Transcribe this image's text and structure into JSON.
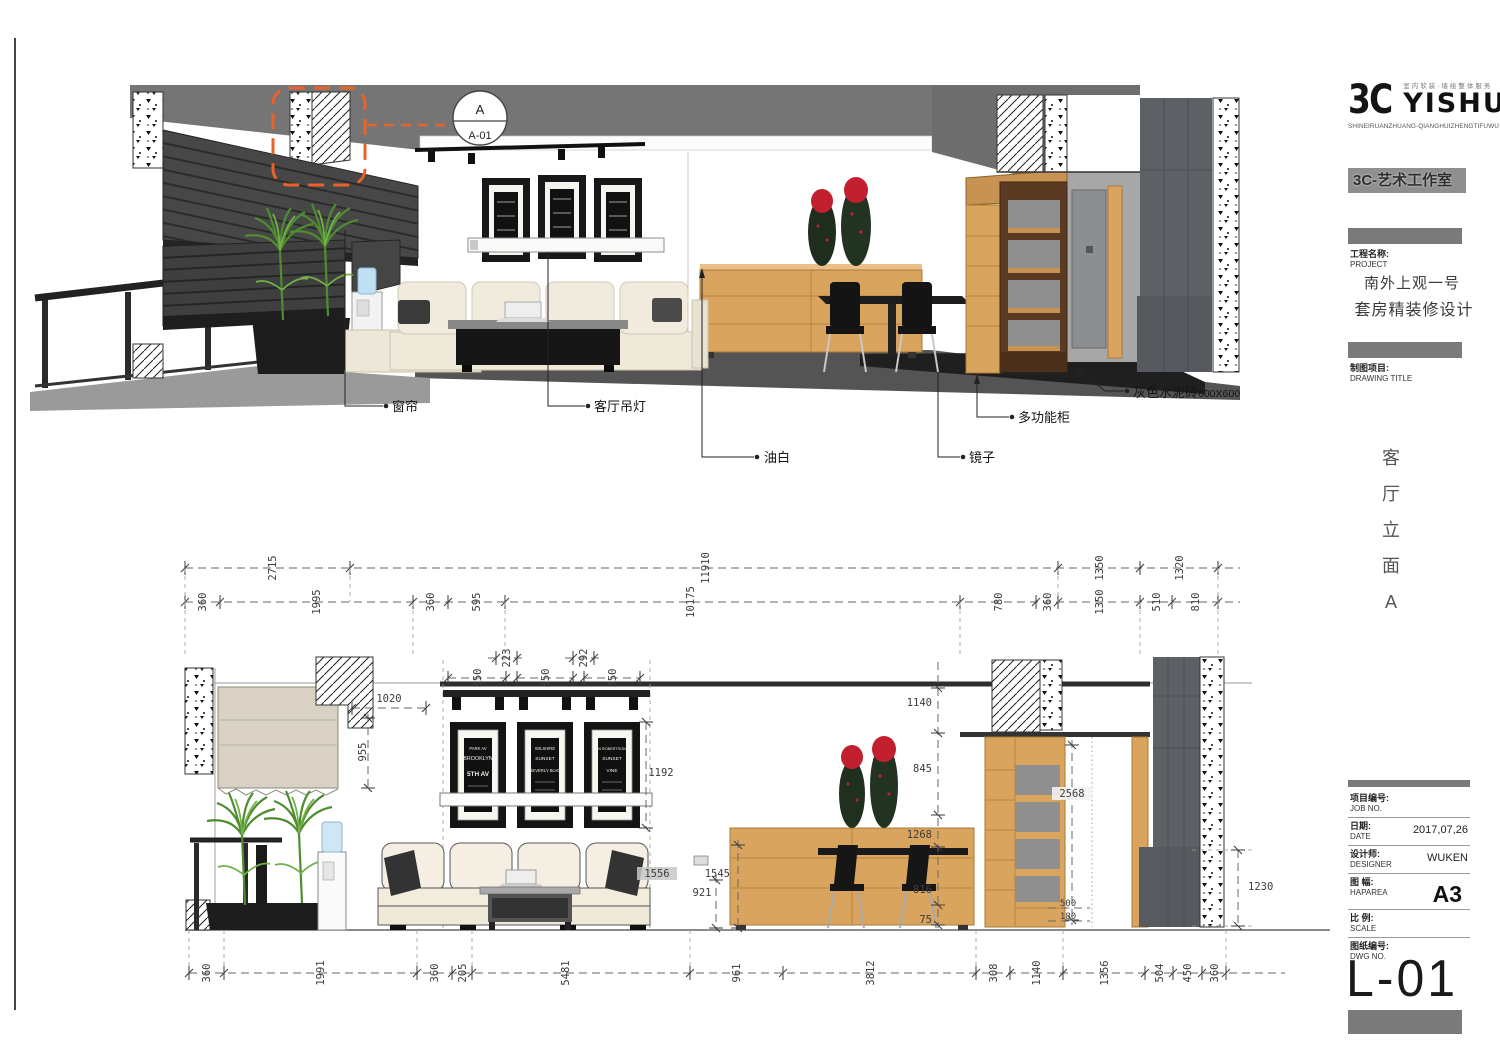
{
  "titleblock": {
    "logo_mark": "3C",
    "logo_name": "YISHU",
    "logo_tagline_cn": "室内软装·墙绘整体服务",
    "logo_tagline_py": "SHINEIRUANZHUANG-QIANGHUIZHENGTIFUWU",
    "studio": "3C-艺术工作室",
    "project_label_cn": "工程名称:",
    "project_label_en": "PROJECT",
    "project_name_line1": "南外上观一号",
    "project_name_line2": "套房精装修设计",
    "drawing_label_cn": "制图项目:",
    "drawing_label_en": "DRAWING TITLE",
    "title_chars": [
      "客",
      "厅",
      "立",
      "面",
      "A"
    ],
    "rows": [
      {
        "cn": "项目编号:",
        "en": "JOB NO.",
        "value": ""
      },
      {
        "cn": "日期:",
        "en": "DATE",
        "value": "2017,07,26"
      },
      {
        "cn": "设计师:",
        "en": "DESIGNER",
        "value": "WUKEN"
      },
      {
        "cn": "图 幅:",
        "en": "HAPAREA",
        "value": "A3"
      },
      {
        "cn": "比 例:",
        "en": "SCALE",
        "value": ""
      },
      {
        "cn": "图纸编号:",
        "en": "DWG NO.",
        "value": ""
      }
    ],
    "dwg_no": "L-01"
  },
  "callouts": {
    "curtain": "窗帘",
    "pendant_lamp": "客厅吊灯",
    "oil_white": "油白",
    "mirror": "镜子",
    "multi_cabinet": "多功能柜",
    "tile_cn": "灰色水泥砖",
    "tile_size": "600X600",
    "section_letter": "A",
    "section_ref": "A-01"
  },
  "posters": {
    "f1": [
      "PARK AV",
      "BROOKLYN",
      "5TH AV"
    ],
    "f2": [
      "WILSHIRE",
      "SUNSET",
      "BEVERLY BLVD"
    ],
    "f3": [
      "N ROBERTSON",
      "SUNSET",
      "VINE"
    ]
  },
  "dims": {
    "row1": [
      "2715",
      "11910",
      "1350",
      "1320"
    ],
    "row2": [
      "360",
      "1995",
      "360",
      "595",
      "10175",
      "780",
      "360",
      "1350",
      "510",
      "810"
    ],
    "frame_gaps": [
      "223",
      "292"
    ],
    "frame_widths": [
      "350",
      "350",
      "350"
    ],
    "d1020": "1020",
    "d955": "955",
    "d1192": "1192",
    "d1556": "1556",
    "d921": "921",
    "d1545": "1545",
    "right_chain": [
      "1140",
      "845",
      "1268",
      "816",
      "75"
    ],
    "d2568": "2568",
    "d500": "500",
    "d180": "180",
    "d1230": "1230",
    "bottom": [
      "360",
      "1991",
      "360",
      "205",
      "5481",
      "961",
      "3812",
      "308",
      "1140",
      "1356",
      "504",
      "450",
      "360"
    ]
  },
  "colors": {
    "accent_orange": "#E8622A",
    "wood": "#D9A55E",
    "dark_wood": "#5A3A22",
    "column_gray": "#5D6166",
    "sofa_cream": "#EFE9DA",
    "flower_red": "#C2202E"
  }
}
